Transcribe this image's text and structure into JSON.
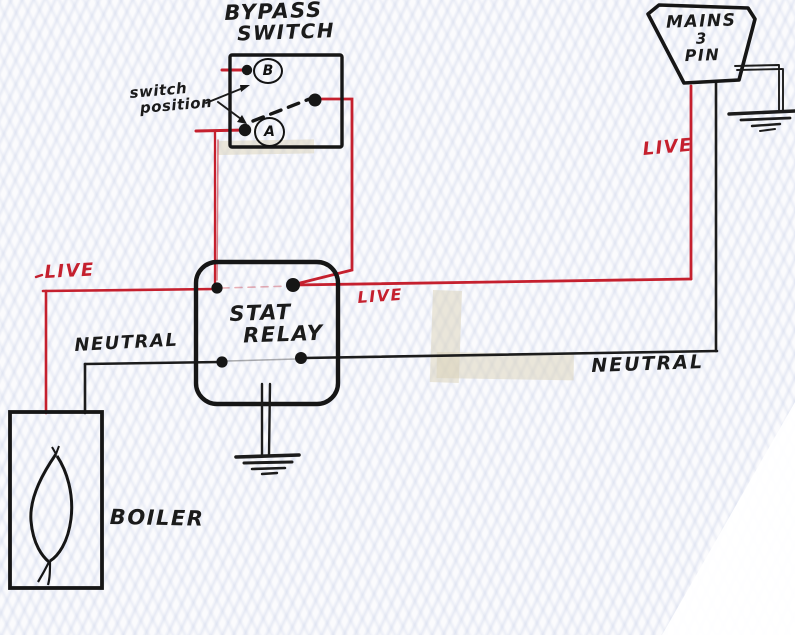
{
  "colors": {
    "live_wire": "#c5202e",
    "neutral_wire": "#1c1c1c",
    "paper": "#fbfbfd"
  },
  "components": {
    "bypass_switch": {
      "title_line1": "BYPASS",
      "title_line2": "SWITCH",
      "terminal_b_label": "B",
      "terminal_a_label": "A",
      "annotation_line1": "switch",
      "annotation_line2": "position"
    },
    "mains_plug": {
      "title_line1": "MAINS",
      "title_line2": "3",
      "title_line3": "PIN"
    },
    "stat_relay": {
      "title_line1": "STAT",
      "title_line2": "RELAY"
    },
    "boiler": {
      "title": "BOILER"
    }
  },
  "wire_labels": {
    "live_left": "LIVE",
    "live_center": "LIVE",
    "live_right": "LIVE",
    "neutral_left": "NEUTRAL",
    "neutral_right": "NEUTRAL"
  }
}
